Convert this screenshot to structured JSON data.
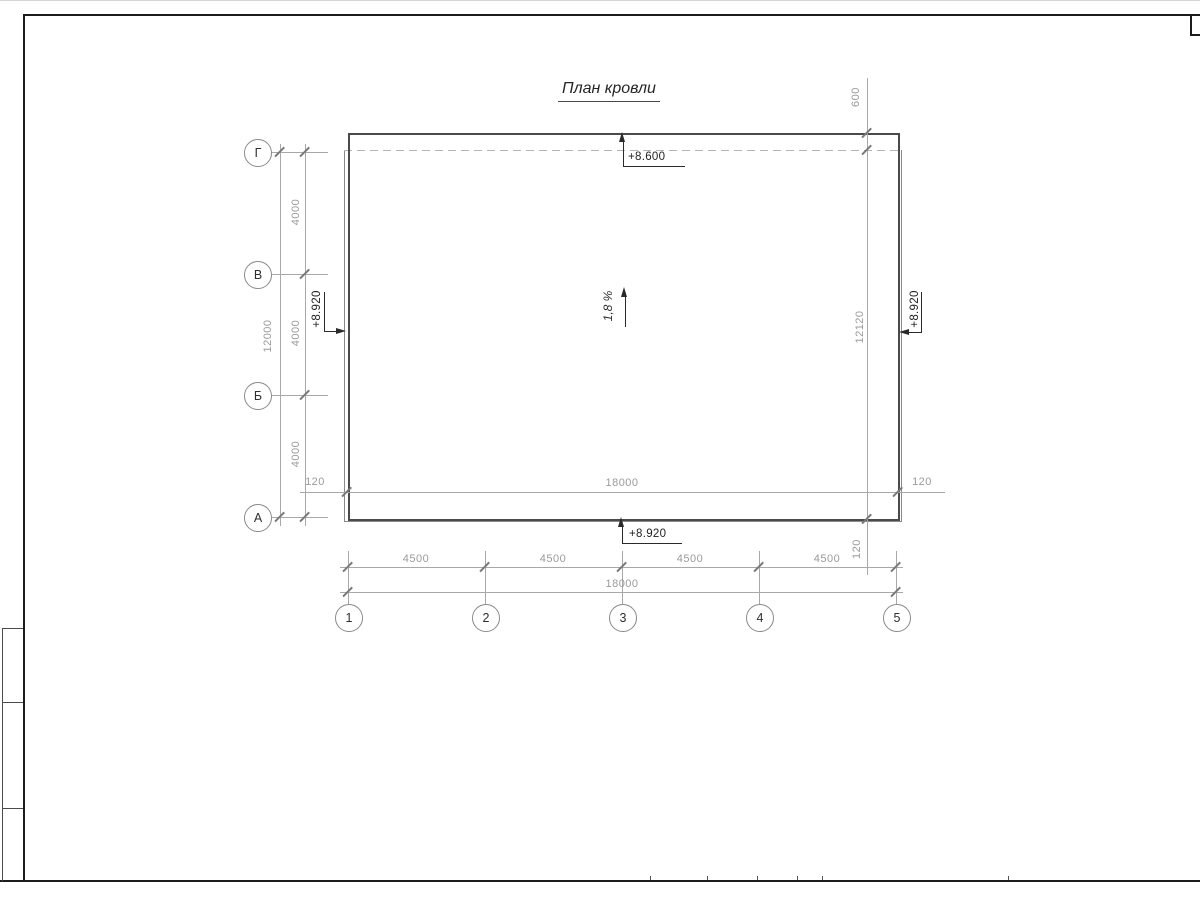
{
  "title": "План кровли",
  "grid": {
    "row_axes": [
      "Г",
      "В",
      "Б",
      "А"
    ],
    "col_axes": [
      "1",
      "2",
      "3",
      "4",
      "5"
    ]
  },
  "dims": {
    "left_segments": [
      "4000",
      "4000",
      "4000"
    ],
    "left_total": "12000",
    "width_line": {
      "left_offset": "120",
      "total": "18000",
      "right_offset": "120"
    },
    "right_line": {
      "top": "600",
      "total": "12120",
      "bottom_offset": "120"
    },
    "bottom_segments": [
      "4500",
      "4500",
      "4500",
      "4500"
    ],
    "bottom_total": "18000"
  },
  "elevations": {
    "top": "+8.600",
    "left": "+8.920",
    "right": "+8.920",
    "bottom": "+8.920"
  },
  "slope": "1,8 %",
  "colors": {
    "outline_strong": "#4a4a4a",
    "outline_light": "#8a8a8a",
    "dimension": "#a8a8a8",
    "dim_text": "#9a9a9a",
    "dark_text": "#1f1f1f",
    "frame": "#1c1c1c"
  }
}
